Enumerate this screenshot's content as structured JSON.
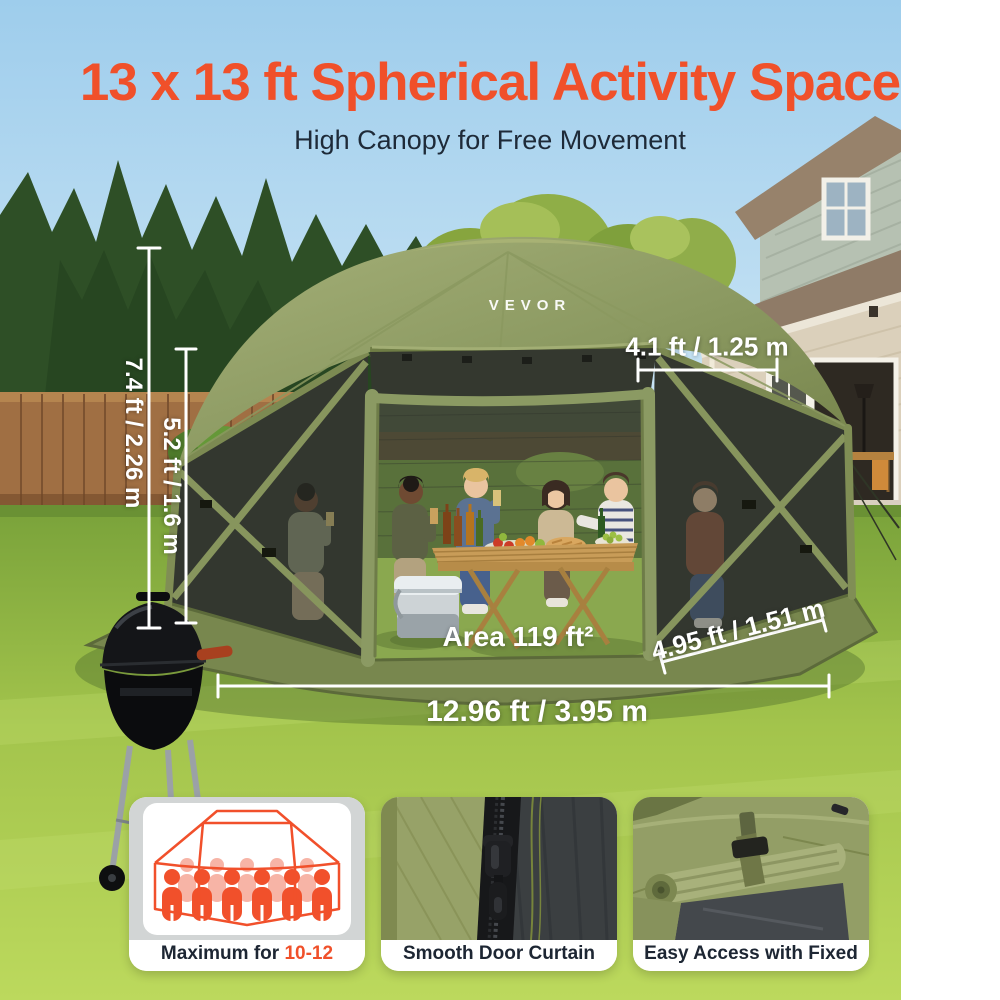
{
  "header": {
    "title": "13 x 13 ft Spherical Activity Space",
    "subtitle": "High Canopy for Free Movement"
  },
  "brand": {
    "logo": "VEVOR"
  },
  "dimensions": {
    "total_height": "7.4 ft / 2.26 m",
    "wall_height": "5.2 ft / 1.6 m",
    "roof_panel_width": "4.1 ft / 1.25 m",
    "side_panel_width": "4.95 ft / 1.51 m",
    "total_width": "12.96 ft / 3.95 m",
    "area": "Area 119 ft²"
  },
  "features": [
    {
      "prefix": "Maximum for ",
      "highlight": "10-12 People"
    },
    {
      "caption": "Smooth Door Curtain Zippers"
    },
    {
      "caption": "Easy Access with Fixed Straps"
    }
  ],
  "colors": {
    "accent_orange": "#f0502a",
    "canopy_olive": "#8b9961",
    "subtitle_dark": "#1e2a38",
    "card_gray": "#d2d5d5",
    "dimension_text": "#ffffff"
  }
}
